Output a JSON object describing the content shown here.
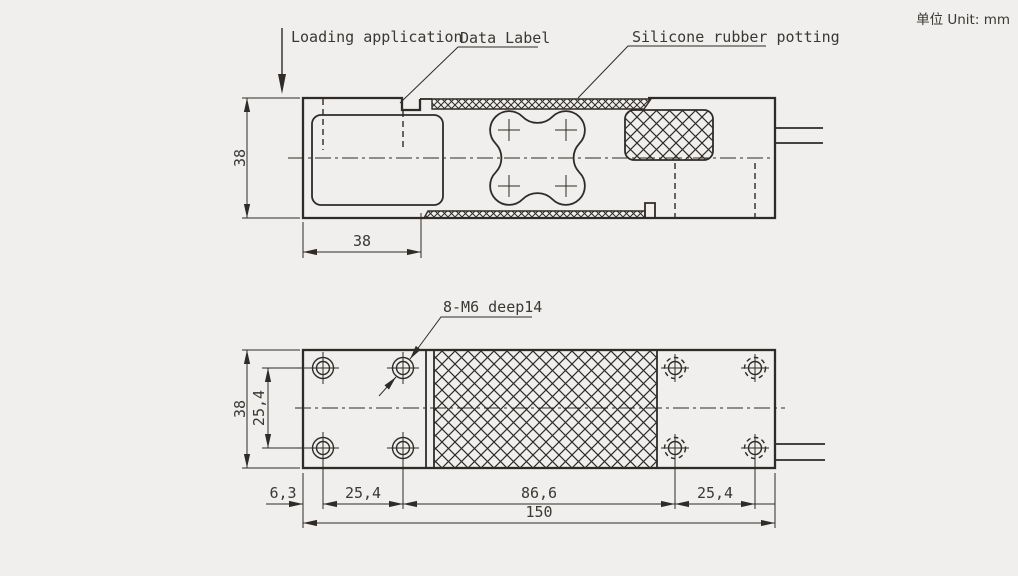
{
  "note": {
    "unit": "单位 Unit: mm"
  },
  "colors": {
    "background": "#f0efed",
    "line": "#2e2b28",
    "text": "#3a3734"
  },
  "top_view": {
    "label_loading": "Loading application",
    "label_data": "Data Label",
    "label_silicone": "Silicone rubber potting",
    "dim_height": "38",
    "dim_mount_length": "38"
  },
  "bottom_view": {
    "label_holes": "8-M6 deep14",
    "dim_height": "38",
    "dim_hole_rows": "25,4",
    "dim_edge_offset": "6,3",
    "dim_hole_cols_left": "25,4",
    "dim_middle": "86,6",
    "dim_hole_cols_right": "25,4",
    "dim_total": "150"
  }
}
